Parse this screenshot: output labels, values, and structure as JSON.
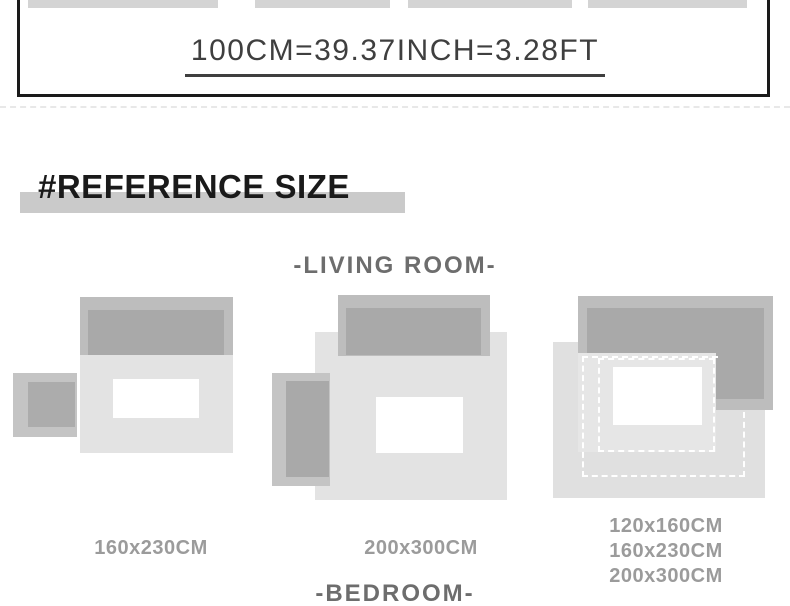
{
  "conversion_banner": {
    "text": "100CM=39.37INCH=3.28FT"
  },
  "heading": {
    "text": "#REFERENCE SIZE"
  },
  "sections": {
    "living_room": "-LIVING ROOM-",
    "bedroom": "-BEDROOM-"
  },
  "diagrams": [
    {
      "name": "living-room-rug-small",
      "label": "160x230CM"
    },
    {
      "name": "living-room-rug-large",
      "label": "200x300CM"
    },
    {
      "name": "bedroom-rug-options",
      "labels": [
        "120x160CM",
        "160x230CM",
        "200x300CM"
      ]
    }
  ],
  "palette": {
    "thumbnail_gray": "#d4d4d4",
    "border_black": "#1a1a1a",
    "title_gray": "#3f3f3f",
    "highlight_gray": "#cacaca",
    "room_label_gray": "#6d6d6d",
    "size_label_gray": "#9b9b9b",
    "rug_light": "#e3e3e3",
    "furniture_outer": "#bdbdbd",
    "furniture_inner": "#a9a9a9",
    "small_rug_outer": "#c4c4c4",
    "small_rug_inner": "#acacac"
  }
}
